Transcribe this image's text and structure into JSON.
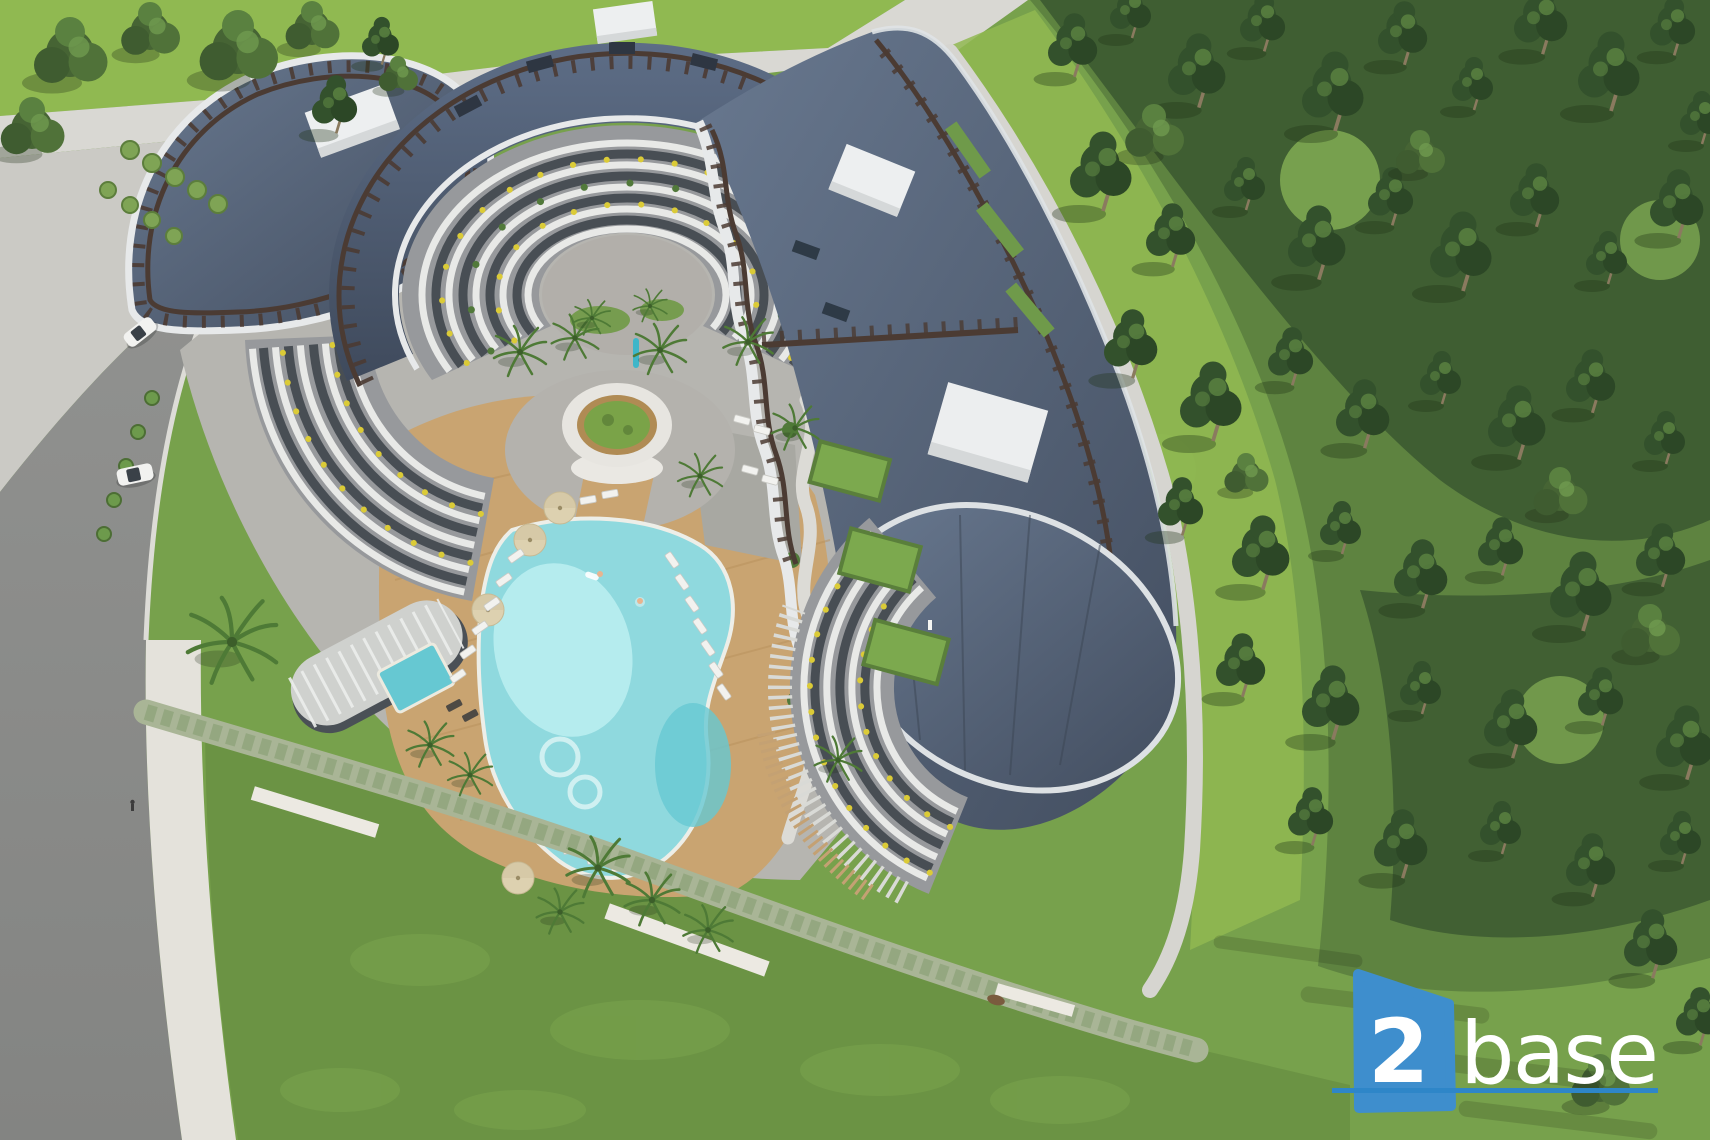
{
  "scene": {
    "subject": "aerial view of a curved luxury apartment complex with courtyard pool, surrounded by lawns, a road and a pine forest",
    "cars_on_road": 2,
    "rooftop_units": 4,
    "building_wings": 2
  },
  "logo": {
    "number": "2",
    "word": "base"
  },
  "palette": {
    "lawn-base": "#77a14c",
    "lawn-bright": "#90b951",
    "lawn-bottom": "#6b9344",
    "forest-floor": "#5e8340",
    "forest-dark": "#3c5a31",
    "forest-light": "#86b055",
    "road": "#8c8d8b",
    "sidewalk": "#d9d8d3",
    "pavement": "#cbcac5",
    "path-light": "#d6d5d0",
    "plaza": "#b6b5b0",
    "roof-top": "#68788f",
    "roof-deep": "#434e60",
    "trellis": "#4b3b33",
    "fascia": "#e7e9ea",
    "facade": "#97999c",
    "glass": "#484e54",
    "floor-white": "#e8e9e7",
    "planter-yellow": "#dbcb37",
    "topiary": "#51793a",
    "deck": "#c9a471",
    "pool": "#8fd9de",
    "pool-shallow": "#bceef1",
    "pool-deep": "#66c8d2",
    "pool-edge": "#edeee8",
    "hedge": "#a9b596",
    "wall": "#ece9e2",
    "umbrella": "#ddd1b0",
    "lounger": "#f2f2ef",
    "palm": "#4e7a36",
    "pine": "#33512c",
    "pine-light": "#5d8542",
    "tree": "#466434",
    "trunk": "#8a7a5f",
    "car": "#f2f2f0",
    "logo-blue": "#3e8ecd",
    "logo-underline": "#2e86c8",
    "logo-text": "#ffffff"
  }
}
